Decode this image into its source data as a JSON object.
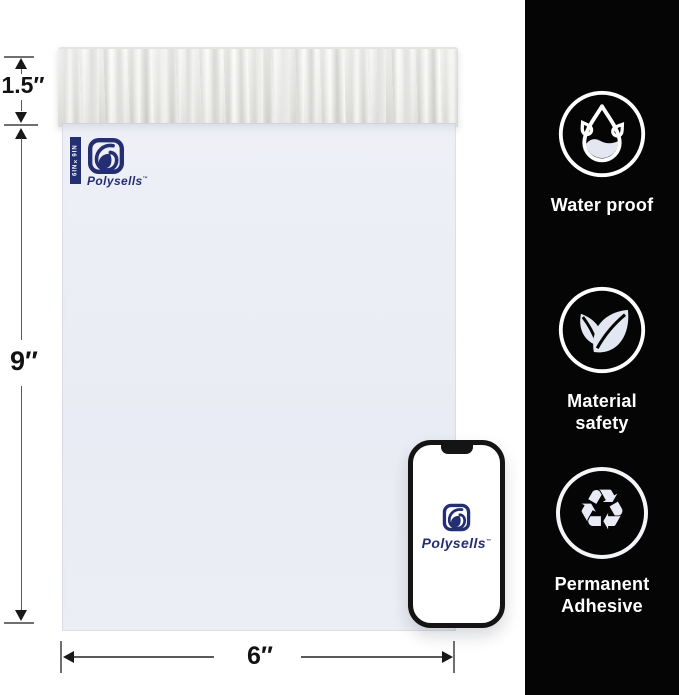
{
  "canvas": {
    "width": 679,
    "height": 695
  },
  "mailer": {
    "brand": "Polysells",
    "trademark": "™",
    "size_tag": "6IN×9IN",
    "brand_color": "#242e73",
    "body_color": "#e9ecf4",
    "flap_color": "#f2f2ef"
  },
  "dimensions": {
    "flap": "1.5″",
    "height": "9″",
    "width": "6″"
  },
  "features": [
    {
      "id": "waterproof",
      "icon": "water-drop-icon",
      "label": "Water proof"
    },
    {
      "id": "material-safety",
      "icon": "leaves-icon",
      "label": "Material safety"
    },
    {
      "id": "permanent-adhesive",
      "icon": "recycle-icon",
      "label": "Permanent Adhesive"
    }
  ],
  "phone": {
    "brand": "Polysells",
    "trademark": "™"
  },
  "colors": {
    "sidebar_bg": "#050505",
    "icon_stroke": "#ffffff",
    "icon_fill": "#e3e7f2",
    "dimension_line": "#5a5a5a",
    "dimension_text": "#121212"
  }
}
